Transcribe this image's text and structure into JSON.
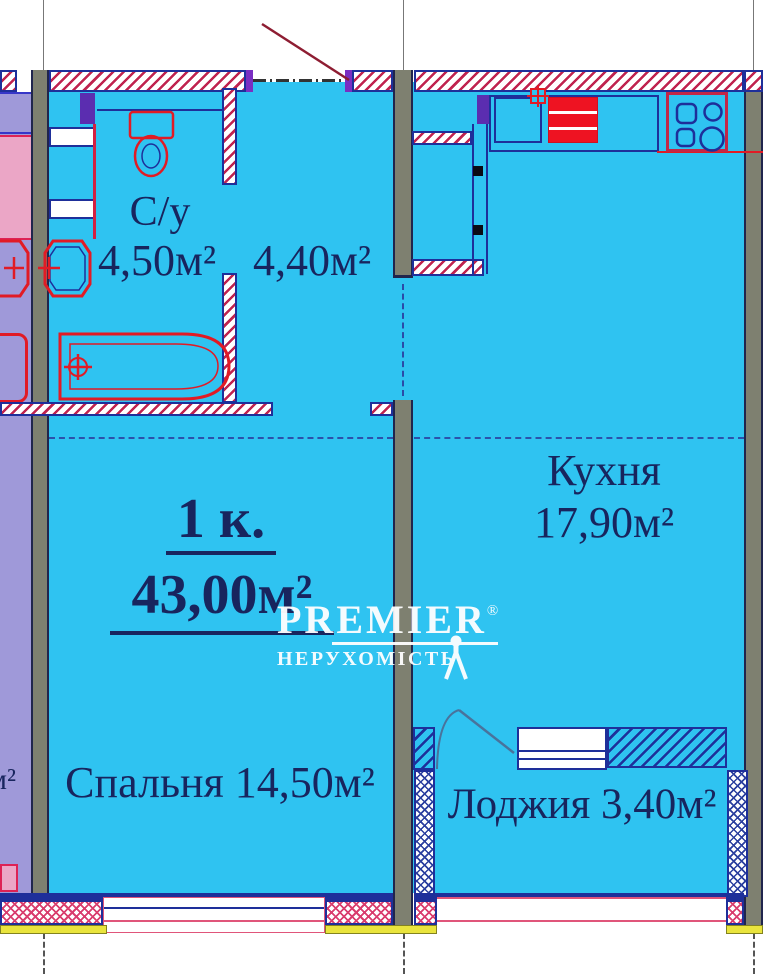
{
  "apartment": {
    "rooms_count_label": "1 к.",
    "total_area_label": "43,00м²"
  },
  "rooms": {
    "bathroom": {
      "name": "С/у",
      "area": "4,50м²"
    },
    "hallway": {
      "area": "4,40м²"
    },
    "kitchen": {
      "name": "Кухня",
      "area": "17,90м²"
    },
    "bedroom": {
      "label": "Спальня 14,50м²"
    },
    "loggia": {
      "label": "Лоджия 3,40м²"
    }
  },
  "neighbor": {
    "area_fragment": "м²"
  },
  "watermark": {
    "brand": "PREMIER",
    "registered": "®",
    "tagline": "НЕРУХОМІСТЬ"
  },
  "colors": {
    "room_fill": "#2fc3f1",
    "neighbor_fill": "#9f99d9",
    "wall_gray": "#7e8070",
    "hatch_red": "#c0234f",
    "line_navy": "#1e2f9a",
    "fixture_red": "#e11b25",
    "sill_yellow": "#e9e43d",
    "text_navy": "#18255e",
    "watermark_white": "#ffffff"
  },
  "fixtures": [
    "toilet",
    "washbasin",
    "bathtub",
    "kitchen-sink",
    "refrigerator",
    "stove"
  ]
}
